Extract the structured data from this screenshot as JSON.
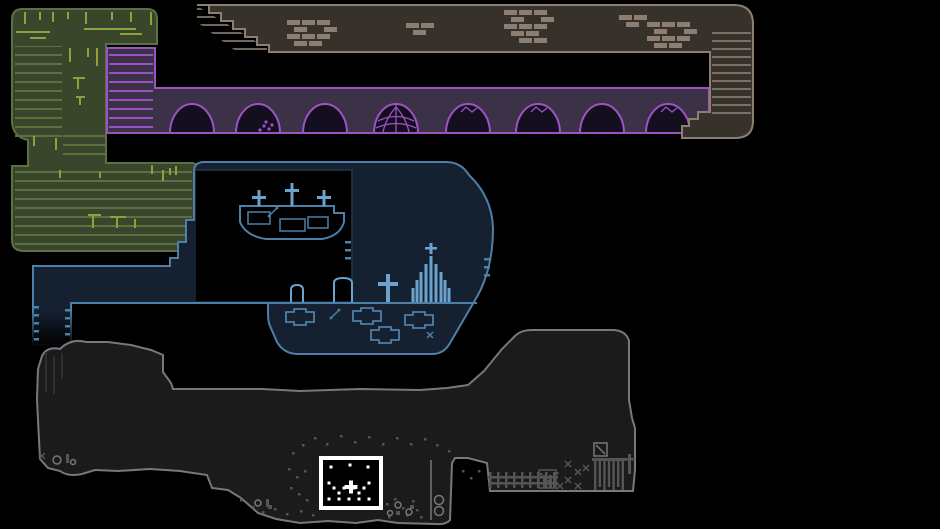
{
  "canvas": {
    "width": 940,
    "height": 529
  },
  "colors": {
    "black": "#000000",
    "stone_fill": "#37312c",
    "stone_line": "#8c7f72",
    "purple_fill": "#3c3247",
    "purple_line": "#9c52c4",
    "dome_fill": "#140f1e",
    "green_fill": "#39462b",
    "green_line": "#5c7140",
    "vine": "#92a03b",
    "blue_fill": "#152030",
    "blue_line": "#4d80a8",
    "blue_light": "#6ba3cc",
    "blue_dim": "#263850",
    "cave_fill": "#1b1b1b",
    "cave_line": "#787878",
    "cave_deco": "#555555",
    "marker_white": "#ffffff"
  },
  "stone": {
    "brick_clusters": [
      {
        "x": 287,
        "y": 20,
        "cols": 3,
        "rows": 4
      },
      {
        "x": 406,
        "y": 23,
        "cols": 2,
        "rows": 2
      },
      {
        "x": 504,
        "y": 10,
        "cols": 3,
        "rows": 5
      },
      {
        "x": 619,
        "y": 15,
        "cols": 2,
        "rows": 2
      },
      {
        "x": 647,
        "y": 22,
        "cols": 3,
        "rows": 4
      }
    ]
  },
  "purple": {
    "domes": [
      {
        "cx": 192,
        "deco": "none"
      },
      {
        "cx": 258,
        "deco": "pile"
      },
      {
        "cx": 325,
        "deco": "none"
      },
      {
        "cx": 396,
        "deco": "web"
      },
      {
        "cx": 468,
        "deco": "scratch"
      },
      {
        "cx": 538,
        "deco": "scratch"
      },
      {
        "cx": 602,
        "deco": "none"
      },
      {
        "cx": 668,
        "deco": "scratch"
      }
    ]
  },
  "green": {
    "vines": [
      [
        25,
        12,
        12,
        "v"
      ],
      [
        40,
        12,
        8,
        "v"
      ],
      [
        53,
        12,
        10,
        "v"
      ],
      [
        68,
        12,
        7,
        "v"
      ],
      [
        86,
        12,
        12,
        "v"
      ],
      [
        112,
        12,
        8,
        "v"
      ],
      [
        131,
        12,
        10,
        "v"
      ],
      [
        151,
        12,
        13,
        "v"
      ],
      [
        16,
        32,
        34,
        "h"
      ],
      [
        84,
        29,
        52,
        "h"
      ],
      [
        30,
        38,
        16,
        "h"
      ],
      [
        120,
        34,
        22,
        "h"
      ],
      [
        70,
        48,
        14,
        "v"
      ],
      [
        88,
        48,
        9,
        "v"
      ],
      [
        97,
        48,
        18,
        "v"
      ],
      [
        73,
        78,
        12,
        "h"
      ],
      [
        78,
        78,
        11,
        "v"
      ],
      [
        76,
        97,
        9,
        "h"
      ],
      [
        80,
        97,
        8,
        "v"
      ],
      [
        34,
        136,
        10,
        "v"
      ],
      [
        56,
        138,
        12,
        "v"
      ],
      [
        88,
        215,
        13,
        "h"
      ],
      [
        93,
        215,
        13,
        "v"
      ],
      [
        110,
        217,
        16,
        "h"
      ],
      [
        117,
        217,
        11,
        "v"
      ],
      [
        135,
        219,
        9,
        "v"
      ],
      [
        60,
        170,
        8,
        "v"
      ],
      [
        100,
        172,
        6,
        "v"
      ],
      [
        152,
        165,
        9,
        "v"
      ],
      [
        163,
        170,
        11,
        "v"
      ],
      [
        170,
        168,
        7,
        "v"
      ],
      [
        176,
        166,
        9,
        "v"
      ]
    ]
  },
  "blue": {
    "island_tombs": [
      [
        248,
        212,
        22,
        12
      ],
      [
        280,
        219,
        25,
        12
      ],
      [
        308,
        217,
        20,
        11
      ]
    ],
    "island_crosses": [
      [
        259,
        190,
        16
      ],
      [
        292,
        183,
        23
      ],
      [
        324,
        190,
        16
      ]
    ],
    "gravestones": [
      {
        "type": "stone",
        "x": 291,
        "w": 12,
        "h": 17
      },
      {
        "type": "stone",
        "x": 334,
        "w": 18,
        "h": 24
      },
      {
        "type": "cross",
        "x": 388
      },
      {
        "type": "cathedral",
        "x": 431
      }
    ],
    "coffins": [
      [
        300,
        317
      ],
      [
        367,
        316
      ],
      [
        419,
        320
      ],
      [
        385,
        335
      ]
    ],
    "dashes": {
      "left": [
        [
          34,
          306
        ],
        [
          34,
          314
        ],
        [
          34,
          322
        ],
        [
          34,
          330
        ],
        [
          34,
          338
        ]
      ],
      "inner": [
        [
          65,
          309
        ],
        [
          65,
          317
        ],
        [
          65,
          325
        ],
        [
          65,
          333
        ]
      ],
      "right": [
        [
          484,
          258
        ],
        [
          484,
          266
        ],
        [
          484,
          274
        ]
      ],
      "hole": [
        [
          345,
          241
        ],
        [
          345,
          249
        ],
        [
          345,
          257
        ]
      ]
    },
    "bone_items": [
      [
        335,
        314
      ],
      [
        273,
        212
      ]
    ],
    "x_items": [
      [
        430,
        335
      ]
    ]
  },
  "cave": {
    "rubble": [
      [
        302,
        444
      ],
      [
        314,
        437
      ],
      [
        326,
        443
      ],
      [
        340,
        435
      ],
      [
        354,
        441
      ],
      [
        368,
        436
      ],
      [
        382,
        443
      ],
      [
        396,
        437
      ],
      [
        410,
        443
      ],
      [
        424,
        438
      ],
      [
        436,
        444
      ],
      [
        292,
        452
      ],
      [
        448,
        450
      ],
      [
        288,
        468
      ],
      [
        296,
        476
      ],
      [
        304,
        470
      ],
      [
        290,
        487
      ],
      [
        298,
        493
      ],
      [
        306,
        499
      ],
      [
        240,
        499
      ],
      [
        252,
        506
      ],
      [
        262,
        511
      ],
      [
        274,
        508
      ],
      [
        286,
        513
      ],
      [
        300,
        510
      ],
      [
        312,
        514
      ],
      [
        386,
        503
      ],
      [
        394,
        498
      ],
      [
        402,
        507
      ],
      [
        412,
        500
      ],
      [
        388,
        516
      ],
      [
        406,
        514
      ],
      [
        416,
        509
      ],
      [
        420,
        516
      ],
      [
        462,
        470
      ],
      [
        470,
        477
      ],
      [
        478,
        470
      ],
      [
        540,
        473
      ],
      [
        548,
        480
      ],
      [
        556,
        472
      ]
    ],
    "big_rubble": [
      [
        268,
        505
      ],
      [
        396,
        511
      ],
      [
        410,
        505
      ]
    ],
    "pebble_circles": [
      [
        398,
        505,
        3
      ],
      [
        409,
        512,
        3
      ],
      [
        390,
        513,
        2.5
      ],
      [
        57,
        460,
        4
      ],
      [
        73,
        462,
        2.5
      ],
      [
        258,
        503,
        3
      ]
    ],
    "bars": [
      [
        66,
        454,
        3,
        9
      ],
      [
        266,
        499,
        3,
        8
      ]
    ],
    "xmarks": [
      [
        42,
        456
      ],
      [
        568,
        464
      ],
      [
        578,
        472
      ],
      [
        568,
        480
      ],
      [
        578,
        486
      ],
      [
        586,
        468
      ],
      [
        560,
        486
      ]
    ],
    "fence": {
      "x": 489,
      "y": 472,
      "posts": 9,
      "step": 8,
      "post_h": 16,
      "rails": [
        476,
        482
      ],
      "rail_w": 70
    },
    "house": {
      "x": 539,
      "y": 470,
      "w": 17,
      "h": 18,
      "slots": [
        [
          543,
          475
        ],
        [
          549,
          475
        ]
      ]
    },
    "gate": {
      "x": 592,
      "y": 458,
      "bars": 7,
      "step": 4.6,
      "h1": 29,
      "h2": 26,
      "rail_w": 34
    },
    "cross_post": [
      628,
      452
    ],
    "sign": [
      594,
      443,
      13
    ],
    "chain": {
      "x": 431,
      "y1": 460,
      "y2": 520,
      "rings": [
        [
          439,
          500
        ],
        [
          439,
          511
        ]
      ]
    },
    "streaks": [
      [
        46,
        352,
        40
      ],
      [
        54,
        356,
        38
      ],
      [
        62,
        353,
        26
      ]
    ]
  },
  "marker": {
    "x": 321,
    "y": 458,
    "w": 60,
    "h": 50,
    "dots": [
      [
        331,
        467
      ],
      [
        350,
        465
      ],
      [
        368,
        467
      ],
      [
        329,
        483
      ],
      [
        334,
        488
      ],
      [
        339,
        493
      ],
      [
        344,
        488
      ],
      [
        354,
        488
      ],
      [
        359,
        493
      ],
      [
        364,
        488
      ],
      [
        369,
        483
      ],
      [
        329,
        499
      ],
      [
        339,
        499
      ],
      [
        349,
        499
      ],
      [
        359,
        499
      ],
      [
        369,
        499
      ]
    ],
    "plus": [
      351,
      487
    ]
  }
}
